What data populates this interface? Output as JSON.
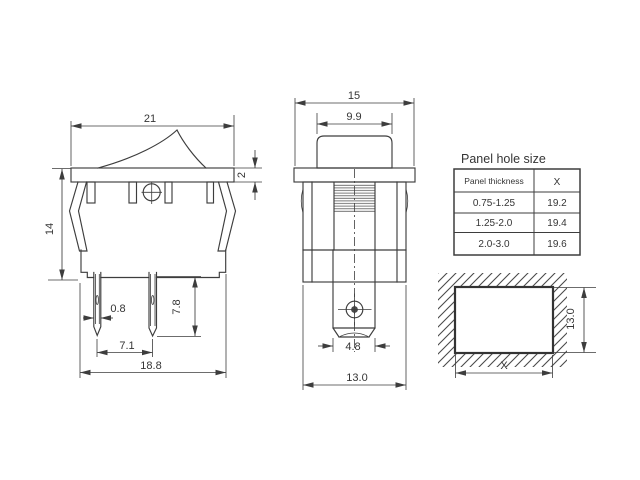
{
  "side_view": {
    "dim_width": "21",
    "dim_flange_thickness": "2",
    "dim_height": "14",
    "dim_pin_width": "0.8",
    "dim_pin_length": "7.8",
    "dim_pin_spacing": "7.1",
    "dim_base_width": "18.8"
  },
  "front_view": {
    "dim_width": "15",
    "dim_rocker_width": "9.9",
    "dim_terminal_width": "4.8",
    "dim_body_width": "13.0"
  },
  "panel_table": {
    "title": "Panel hole size",
    "headers": [
      "Panel thickness",
      "X"
    ],
    "rows": [
      [
        "0.75-1.25",
        "19.2"
      ],
      [
        "1.25-2.0",
        "19.4"
      ],
      [
        "2.0-3.0",
        "19.6"
      ]
    ]
  },
  "hole_view": {
    "dim_height": "13.0",
    "dim_width": "X"
  },
  "colors": {
    "line": "#3d3d3d",
    "background": "#ffffff"
  }
}
